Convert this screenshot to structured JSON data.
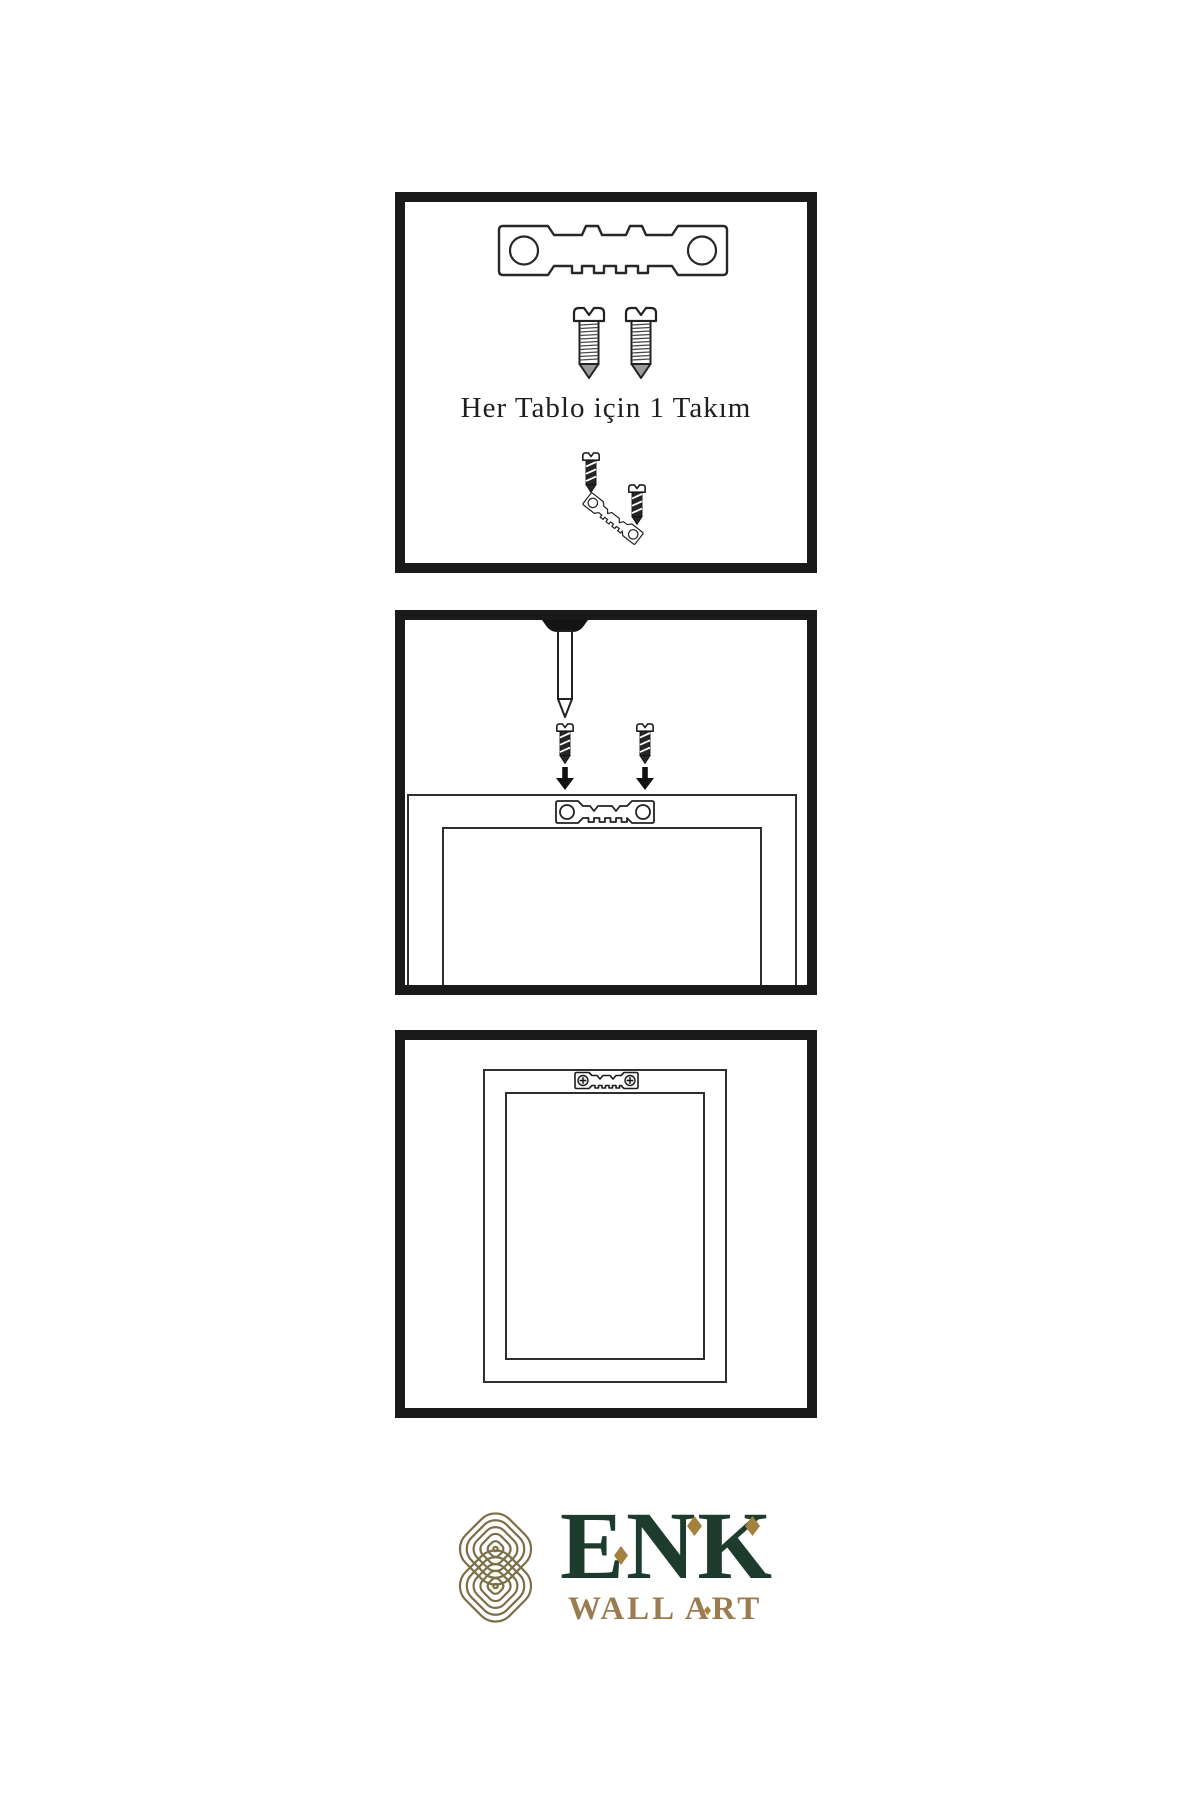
{
  "panels": [
    {
      "name": "hardware-kit",
      "caption": "Her Tablo için 1 Takım",
      "items": [
        "sawtooth-hanger",
        "screw",
        "screw",
        "screw-into-hanger-assembly"
      ]
    },
    {
      "name": "attach-hanger-to-frame",
      "items": [
        "wall-nail",
        "dark-screw",
        "dark-screw",
        "down-arrow",
        "down-arrow",
        "frame-back",
        "sawtooth-hanger"
      ]
    },
    {
      "name": "hang-frame-on-wall",
      "items": [
        "picture-frame",
        "installed-sawtooth-hanger"
      ]
    }
  ],
  "logo": {
    "brand": "ENK",
    "tagline": "WALL ART"
  },
  "colors": {
    "ink": "#1a1a1a",
    "brand_green": "#1d3c2e",
    "brand_gold": "#9b7c50",
    "knot_gold": "#7c6f47",
    "diamond_gold": "#a3823e"
  }
}
